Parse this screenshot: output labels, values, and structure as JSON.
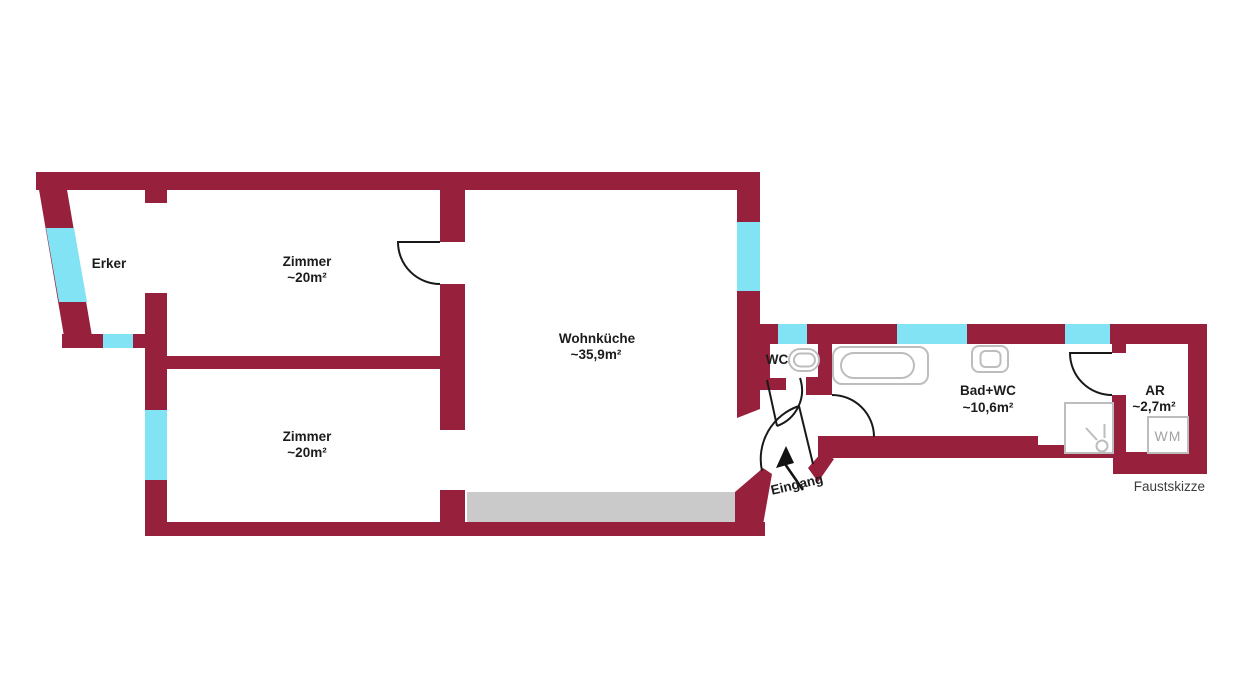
{
  "colors": {
    "wall": "#97203d",
    "window": "#82e3f5",
    "counter": "#cacaca",
    "fixture": "#bdbdbd",
    "door_line": "#191919",
    "label_text": "#1c1c1c",
    "sketch_text": "#3d3d3d",
    "wm_text": "#a3a3a3"
  },
  "rooms": [
    {
      "name": "Erker"
    },
    {
      "name": "Zimmer",
      "area": "~20m²"
    },
    {
      "name": "Zimmer",
      "area": "~20m²"
    },
    {
      "name": "Wohnküche",
      "area": "~35,9m²"
    },
    {
      "name": "WC"
    },
    {
      "name": "Bad+WC",
      "area": "~10,6m²"
    },
    {
      "name": "AR",
      "area": "~2,7m²"
    }
  ],
  "labels": {
    "entrance": "Eingang",
    "washing_machine": "WM",
    "sketch_type": "Faustskizze"
  }
}
